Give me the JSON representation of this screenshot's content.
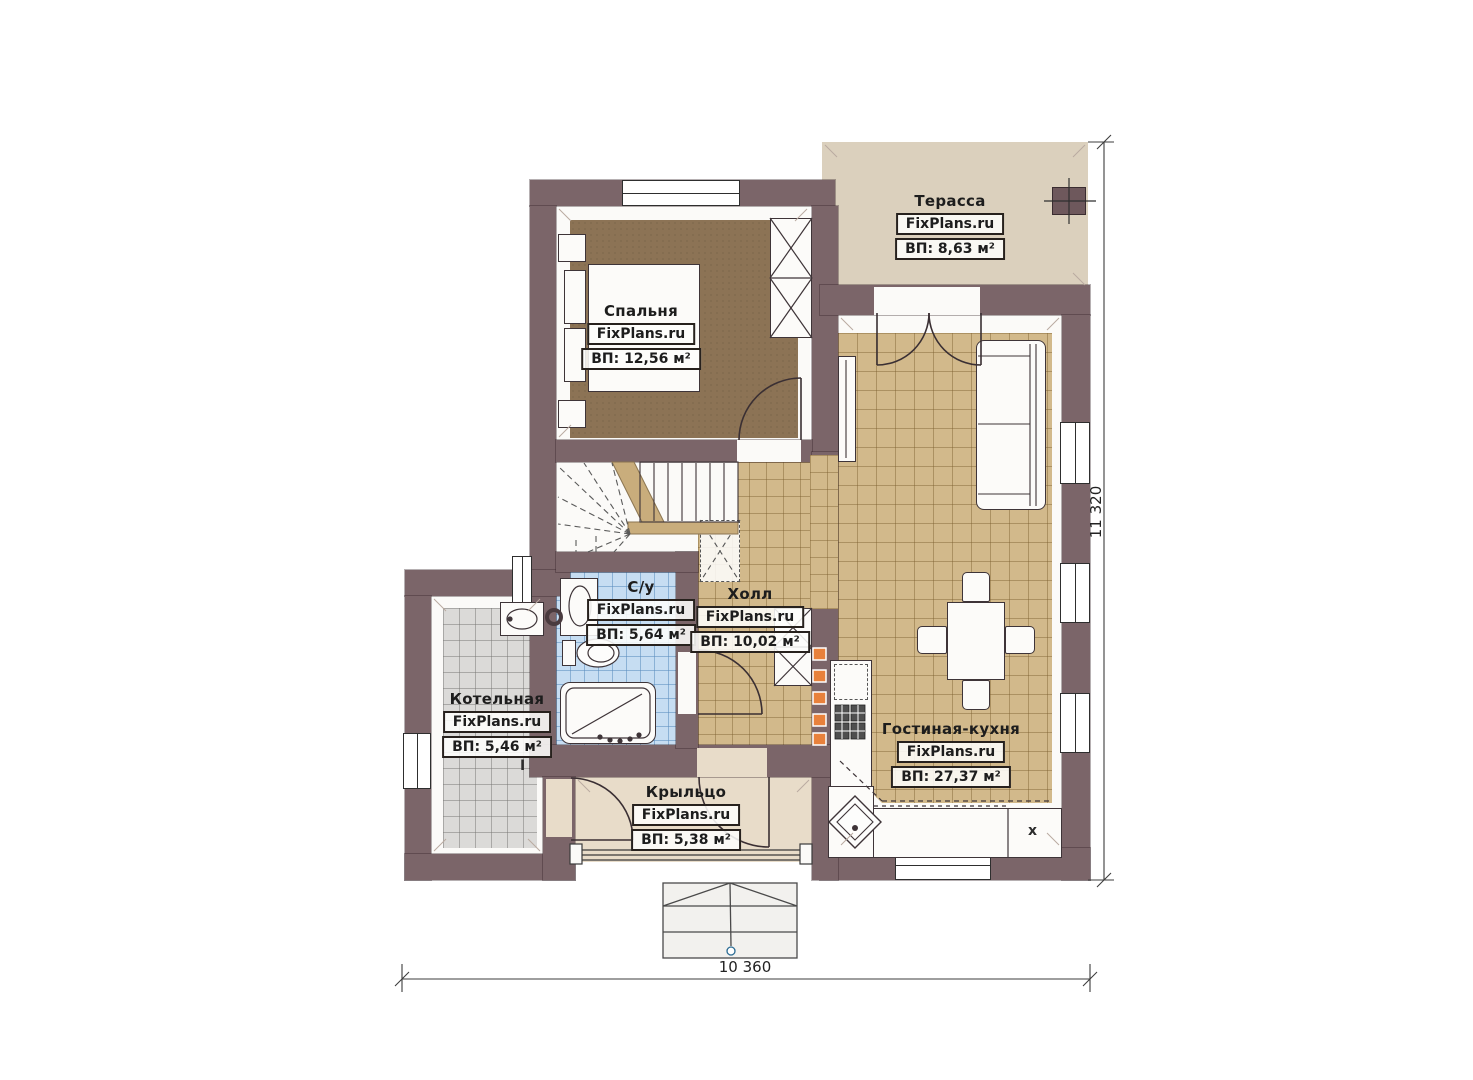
{
  "plan": {
    "brand": "FixPlans.ru",
    "rooms": {
      "terrace": {
        "name": "Терасса",
        "area_label": "ВП: 8,63 м²"
      },
      "bedroom": {
        "name": "Спальня",
        "area_label": "ВП: 12,56 м²"
      },
      "bathroom": {
        "name": "С/у",
        "area_label": "ВП: 5,64 м²"
      },
      "hall": {
        "name": "Холл",
        "area_label": "ВП: 10,02 м²"
      },
      "boiler": {
        "name": "Котельная",
        "area_label": "ВП: 5,46 м²"
      },
      "living": {
        "name": "Гостиная-кухня",
        "area_label": "ВП: 27,37 м²"
      },
      "porch": {
        "name": "Крыльцо",
        "area_label": "ВП: 5,38 м²"
      }
    },
    "dimensions": {
      "overall_width": "10 360",
      "overall_height": "11 320"
    },
    "markers": {
      "kitchen_sink": "x",
      "boiler_mark": "I"
    },
    "colors": {
      "wall": "#7b6569",
      "terrace_floor": "#dbd0bd",
      "bedroom_floor": "#8c7355",
      "tile_tan": "#d2b98b",
      "tile_blue": "#c6ddf2",
      "tile_gray": "#dbdad8",
      "porch_floor": "#e8dcc9",
      "flue_orange": "#e8813c"
    }
  }
}
